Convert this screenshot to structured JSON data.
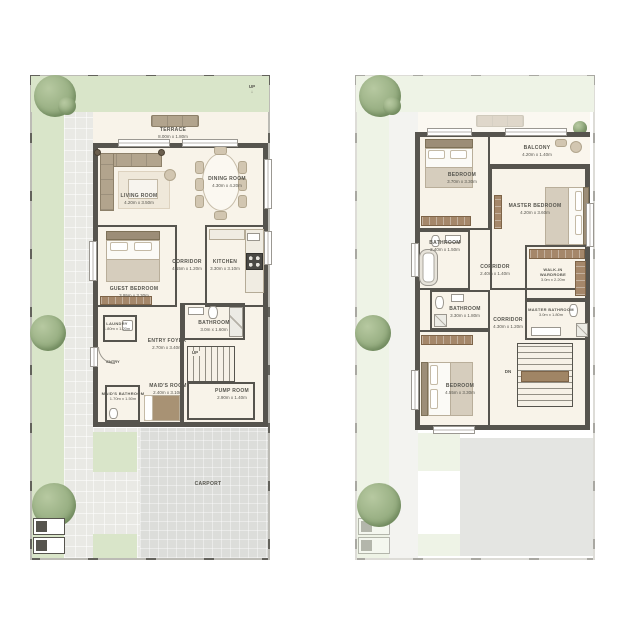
{
  "colors": {
    "grass": "#d9e5c9",
    "path": "#e9e9e5",
    "carport": "#dcddda",
    "wall": "#56544e",
    "floor": "#f8f3e9",
    "furniture": "#cfc3ad",
    "wood": "#a5876a",
    "tree": "#92aa7d",
    "label": "#56554e"
  },
  "gf": {
    "terrace": {
      "name": "TERRACE",
      "dims": "8.00m x 1.80m"
    },
    "living": {
      "name": "LIVING ROOM",
      "dims": "4.20m x 3.50m"
    },
    "dining": {
      "name": "DINING ROOM",
      "dims": "4.30m x 4.20m"
    },
    "guest": {
      "name": "GUEST BEDROOM",
      "dims": "3.95m x 3.30m"
    },
    "corridor": {
      "name": "CORRIDOR",
      "dims": "4.15m x 1.20m"
    },
    "kitchen": {
      "name": "KITCHEN",
      "dims": "3.30m x 3.10m"
    },
    "bath": {
      "name": "BATHROOM",
      "dims": "3.0m x 1.60m"
    },
    "foyer": {
      "name": "ENTRY FOYER",
      "dims": "2.70m x 3.40m"
    },
    "laundry": {
      "name": "LAUNDRY",
      "dims": "1.80m x 1.20m"
    },
    "maid_bath": {
      "name": "MAID'S BATHROOM",
      "dims": "1.70m x 1.50m"
    },
    "maid_room": {
      "name": "MAID'S ROOM",
      "dims": "2.40m x 3.10m"
    },
    "pump": {
      "name": "PUMP ROOM",
      "dims": "2.90m x 1.40m"
    },
    "carport": {
      "name": "CARPORT"
    },
    "up_terrace": "UP",
    "up_arrow": "↓",
    "up_stairs": "UP",
    "entry": "ENTRY"
  },
  "ff": {
    "bedroom1": {
      "name": "BEDROOM",
      "dims": "3.70m x 3.30m"
    },
    "balcony": {
      "name": "BALCONY",
      "dims": "4.20m x 1.40m"
    },
    "master": {
      "name": "MASTER BEDROOM",
      "dims": "4.20m x 3.60m"
    },
    "bath1": {
      "name": "BATHROOM",
      "dims": "2.40m x 1.50m"
    },
    "corridor1": {
      "name": "CORRIDOR",
      "dims": "2.40m x 1.40m"
    },
    "wardrobe": {
      "name": "WALK-IN WARDROBE",
      "dims": "3.0m x 2.20m"
    },
    "bath2": {
      "name": "BATHROOM",
      "dims": "3.30m x 1.80m"
    },
    "corridor2": {
      "name": "CORRIDOR",
      "dims": "4.30m x 1.20m"
    },
    "master_bath": {
      "name": "MASTER BATHROOM",
      "dims": "3.0m x 1.80m"
    },
    "bedroom2": {
      "name": "BEDROOM",
      "dims": "4.55m x 3.30m"
    },
    "dn": "DN"
  }
}
